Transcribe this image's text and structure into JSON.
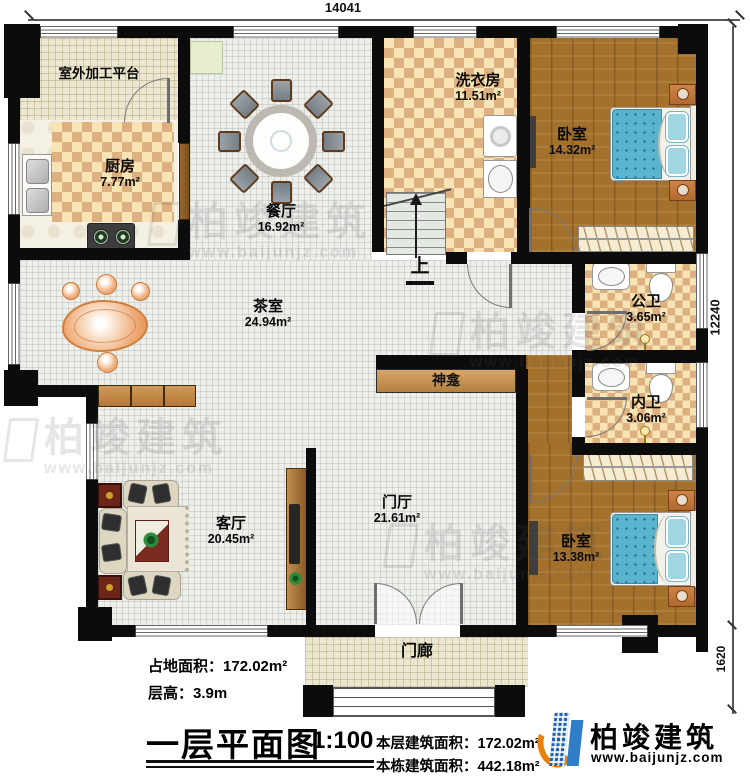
{
  "plan": {
    "dims": {
      "top": "14041",
      "right_main": "12240",
      "right_porch": "1620"
    },
    "stairs_up": "上",
    "rooms": {
      "platform": {
        "name": "室外加工平台"
      },
      "kitchen": {
        "name": "厨房",
        "area": "7.77m²"
      },
      "dining": {
        "name": "餐厅",
        "area": "16.92m²"
      },
      "laundry": {
        "name": "洗衣房",
        "area": "11.51m²"
      },
      "bedroom1": {
        "name": "卧室",
        "area": "14.32m²"
      },
      "tea": {
        "name": "茶室",
        "area": "24.94m²"
      },
      "public_bath": {
        "name": "公卫",
        "area": "3.65m²"
      },
      "private_bath": {
        "name": "内卫",
        "area": "3.06m²"
      },
      "shrine": {
        "name": "神龛"
      },
      "foyer": {
        "name": "门厅",
        "area": "21.61m²"
      },
      "living": {
        "name": "客厅",
        "area": "20.45m²"
      },
      "bedroom2": {
        "name": "卧室",
        "area": "13.38m²"
      },
      "porch": {
        "name": "门廊"
      }
    },
    "legend": {
      "land_area_label": "占地面积：",
      "land_area_value": "172.02m²",
      "floor_height_label": "层高：",
      "floor_height_value": "3.9m",
      "title": "一层平面图",
      "scale": "1:100",
      "this_floor_label": "本层建筑面积：",
      "this_floor_value": "172.02m²",
      "building_label": "本栋建筑面积：",
      "building_value": "442.18m²"
    },
    "brand": {
      "name": "柏竣建筑",
      "site": "www.baijunjz.com"
    },
    "colors": {
      "wall": "#0c0c0c",
      "wood": "#a3712c",
      "bed": "#5ab4cd",
      "logo_blue": "#1e62ab",
      "logo_orange": "#e8820c"
    }
  }
}
